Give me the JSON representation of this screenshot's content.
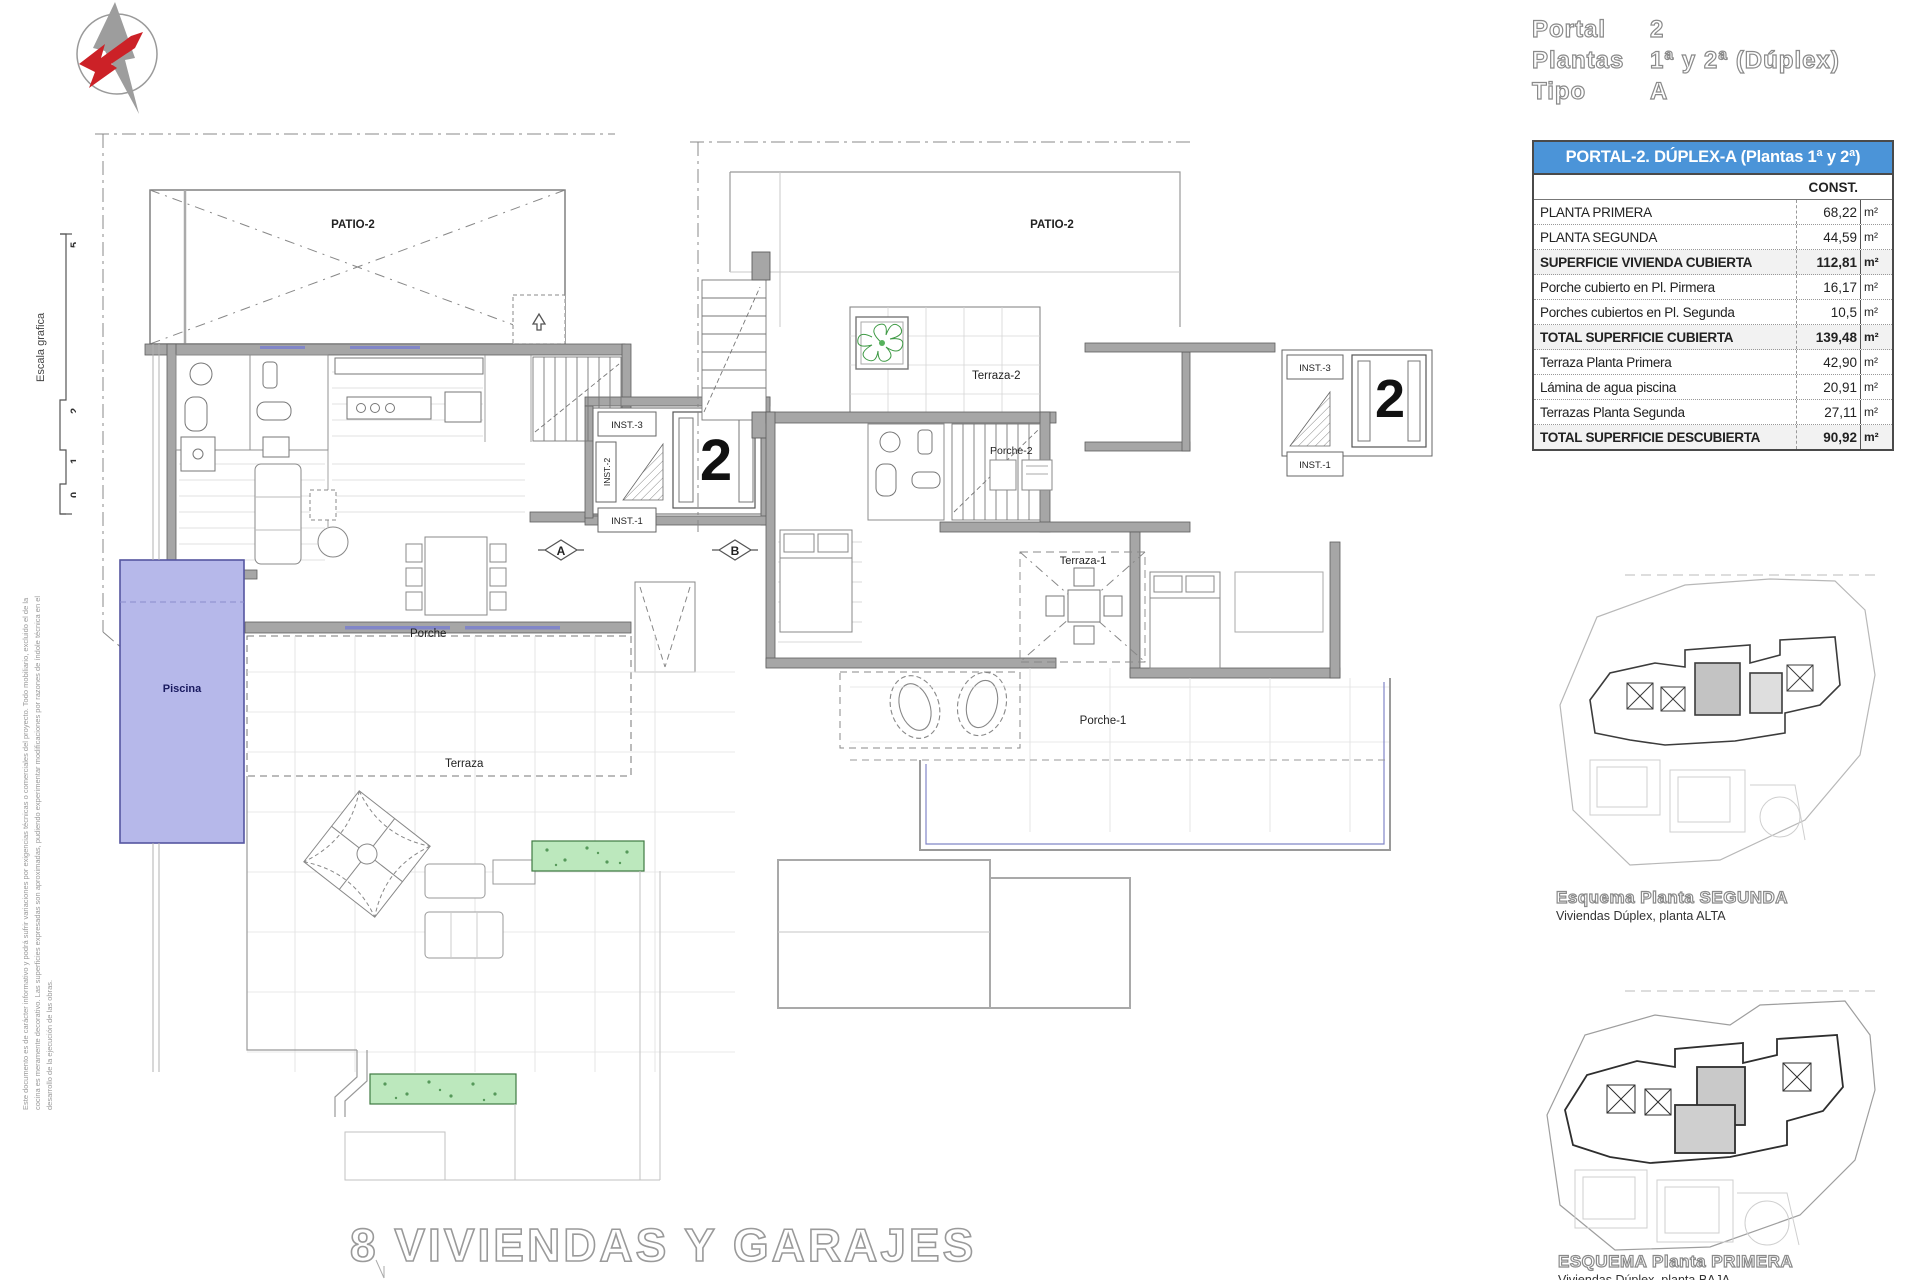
{
  "header": {
    "rows": [
      {
        "label": "Portal",
        "value": "2"
      },
      {
        "label": "Plantas",
        "value": "1ª y 2ª (Dúplex)"
      },
      {
        "label": "Tipo",
        "value": "A"
      }
    ]
  },
  "table": {
    "title": "PORTAL-2. DÚPLEX-A (Plantas 1ª y 2ª)",
    "col_header": "CONST.",
    "rows": [
      {
        "label": "PLANTA PRIMERA",
        "value": "68,22",
        "unit": "m²"
      },
      {
        "label": "PLANTA SEGUNDA",
        "value": "44,59",
        "unit": "m²"
      },
      {
        "label": "SUPERFICIE VIVIENDA CUBIERTA",
        "value": "112,81",
        "unit": "m²"
      },
      {
        "label": "Porche cubierto en Pl. Pirmera",
        "value": "16,17",
        "unit": "m²"
      },
      {
        "label": "Porches cubiertos en Pl. Segunda",
        "value": "10,5",
        "unit": "m²"
      },
      {
        "label": "TOTAL SUPERFICIE CUBIERTA",
        "value": "139,48",
        "unit": "m²"
      },
      {
        "label": "Terraza Planta Primera",
        "value": "42,90",
        "unit": "m²"
      },
      {
        "label": "Lámina de agua piscina",
        "value": "20,91",
        "unit": "m²"
      },
      {
        "label": "Terrazas Planta Segunda",
        "value": "27,11",
        "unit": "m²"
      },
      {
        "label": "TOTAL SUPERFICIE DESCUBIERTA",
        "value": "90,92",
        "unit": "m²"
      }
    ]
  },
  "scale_widget": {
    "label": "Escala grafica",
    "tick_top": "5",
    "tick_mid": "2",
    "tick_low": "1",
    "tick_zero": "0"
  },
  "disclaimer": {
    "line1": "Este documento es de carácter informativo y podrá sufrir variaciones por exigencias técnicas o comerciales del proyecto. Todo mobiliario, excluido el de la cocina es meramente",
    "line2": "decorativo. Las superficies expresadas son aproximadas, pudiendo experimentar modificaciones por razones de índole técnica en el desarrollo de la ejecución de las obras."
  },
  "plan1": {
    "patio": "PATIO-2",
    "porche": "Porche",
    "piscina": "Piscina",
    "terraza": "Terraza",
    "inst3": "INST.-3",
    "inst2": "INST.-2",
    "inst1": "INST.-1",
    "portal_num": "2",
    "marker_a": "A",
    "marker_b": "B"
  },
  "plan2": {
    "patio": "PATIO-2",
    "terraza2": "Terraza-2",
    "porche2": "Porche-2",
    "terraza1": "Terraza-1",
    "porche1": "Porche-1",
    "inst3": "INST.-3",
    "inst1": "INST.-1",
    "portal_num": "2"
  },
  "site_plans": [
    {
      "title": "Esquema Planta SEGUNDA",
      "subtitle": "Viviendas Dúplex, planta ALTA"
    },
    {
      "title": "ESQUEMA Planta PRIMERA",
      "subtitle": "Viviendas Dúplex, planta BAJA"
    }
  ],
  "footer": {
    "title": "8 VIVIENDAS Y GARAJES"
  },
  "colors": {
    "pool": "#b6b8ea",
    "pool_border": "#5555a0",
    "plant_green": "#bce8bd",
    "table_header_blue": "#4b94d8",
    "wall_gray": "#a6a6a6",
    "accent_window_blue": "#8186c8",
    "logo_red": "#cc2127"
  }
}
